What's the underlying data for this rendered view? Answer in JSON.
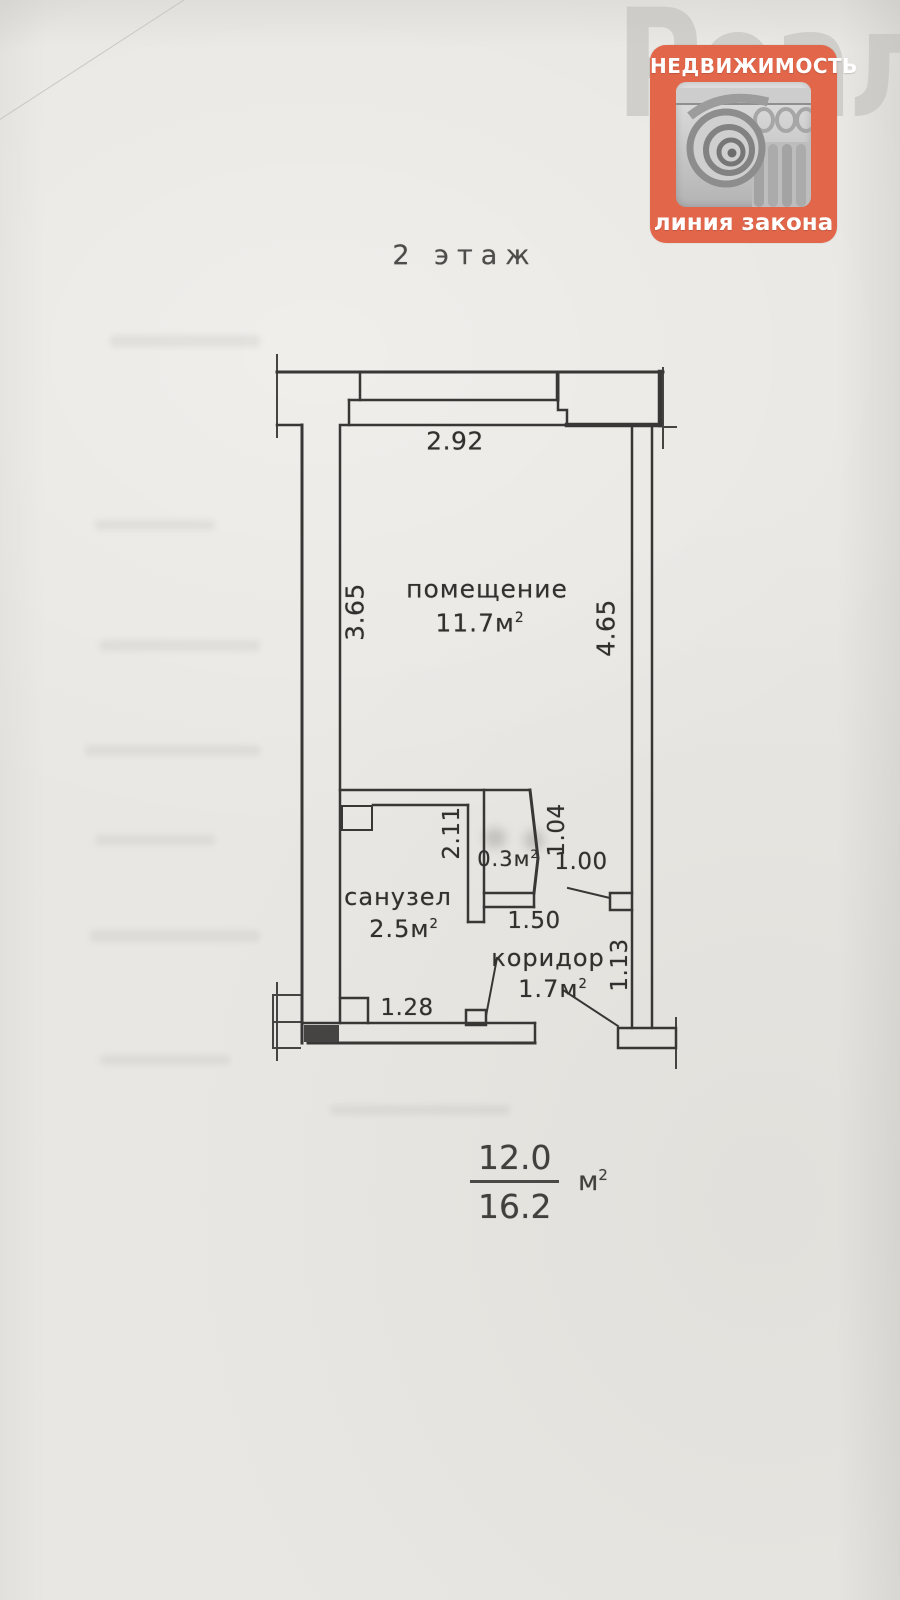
{
  "watermark": {
    "text": "Реалт"
  },
  "logo": {
    "top_text": "НЕДВИЖИМОСТЬ",
    "bottom_text": "линия закона",
    "accent_color": "#e2664a"
  },
  "title": "2 этаж",
  "plan": {
    "rooms": {
      "main": {
        "name": "помещение",
        "area": "11.7м",
        "sup": "2"
      },
      "bathroom": {
        "name": "санузел",
        "area": "2.5м",
        "sup": "2"
      },
      "corridor": {
        "name": "коридор",
        "area": "1.7м",
        "sup": "2"
      },
      "closet": {
        "area": "0.3м",
        "sup": "2"
      }
    },
    "dimensions": {
      "top_width": "2.92",
      "left_height": "3.65",
      "right_height": "4.65",
      "bathroom_height": "2.11",
      "closet_height": "1.04",
      "door_width": "1.00",
      "corridor_width": "1.50",
      "corridor_height": "1.13",
      "bathroom_width": "1.28"
    }
  },
  "totals": {
    "living_area": "12.0",
    "total_area": "16.2",
    "unit": "м",
    "sup": "2"
  }
}
